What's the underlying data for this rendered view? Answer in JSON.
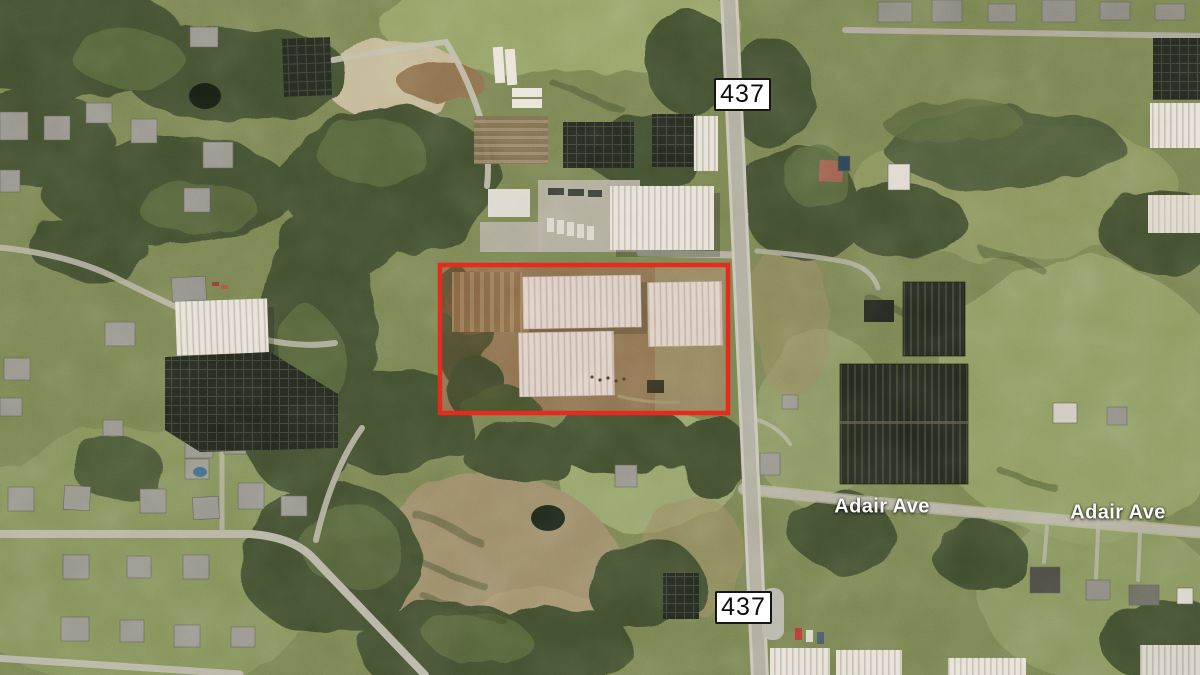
{
  "map": {
    "description": "Aerial imagery of a plant-nursery property at State Road 437 and Adair Ave, outlined in red",
    "route_shields": [
      {
        "text": "437",
        "position": "north"
      },
      {
        "text": "437",
        "position": "south"
      }
    ],
    "street_labels": [
      {
        "text": "Adair Ave",
        "position": "west"
      },
      {
        "text": "Adair Ave",
        "position": "east"
      }
    ],
    "parcel": {
      "x": "440",
      "y": "265",
      "width": "288",
      "height": "148",
      "outline_color": "#e62a1c",
      "outline_width": "4.5"
    },
    "colors": {
      "shield_background": "#ffffff",
      "shield_border": "#161616",
      "shield_text": "#0e0e0e",
      "street_label_text": "#fafaf8",
      "tree_green": "#3f4d2e",
      "grass_green": "#77824f",
      "road_gray": "#aeab9d",
      "greenhouse_white": "#e6e1d7",
      "greenhouse_pink": "#ddcfc5",
      "shade_cloth_dark": "#23281e",
      "bare_soil": "#8b6f4c"
    }
  }
}
